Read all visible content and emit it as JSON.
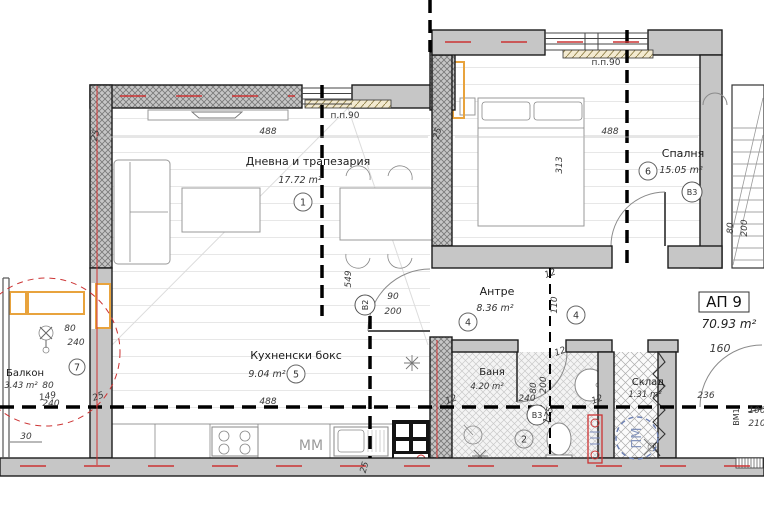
{
  "colors": {
    "wall_gray": "#c6c6c6",
    "accent_red": "#cc3333",
    "accent_orange": "#e8a33d",
    "accent_blue": "#6b7fb3",
    "sill_tan": "#f3ead0"
  },
  "apartment": {
    "label": "АП 9",
    "total_area": "70.93 m²"
  },
  "rooms": [
    {
      "number": "1",
      "name": "Дневна и трапезария",
      "area": "17.72 m²"
    },
    {
      "number": "2",
      "name": "Баня",
      "area": "4.20 m²"
    },
    {
      "number": "4",
      "name": "Антре",
      "area": "8.36 m²"
    },
    {
      "number": "5",
      "name": "Кухненски бокс",
      "area": "9.04 m²"
    },
    {
      "number": "6",
      "name": "Спалня",
      "area": "15.05 m²"
    },
    {
      "number": "7",
      "name": "Балкон",
      "area": "3.43 m²"
    },
    {
      "number": "",
      "name": "Склад",
      "area": "1.31 m²"
    }
  ],
  "doors": [
    {
      "id": "В2",
      "w": "90",
      "h": "200"
    },
    {
      "id": "В3",
      "w": "80",
      "h": "200"
    },
    {
      "id": "ВМ1",
      "w": "100",
      "h": "210"
    }
  ],
  "windows": [
    {
      "label": "п.п.90"
    },
    {
      "label": "п.п.90"
    }
  ],
  "appliances": {
    "dishwasher": "ММ",
    "pm": "ПМ"
  },
  "dims": {
    "living_w": "488",
    "wall_a": "25",
    "col": "25",
    "bedroom_w": "488",
    "bedroom_d": "313",
    "living_h": "549",
    "hall_a": "12",
    "hall_b": "110",
    "hall_c": "12",
    "bath_a": "240",
    "bath_d": "12",
    "bath_e": "12",
    "bath_f": "175",
    "kitchen_w": "488",
    "kitchen_a": "25",
    "balcony_a": "80",
    "balcony_b": "240",
    "balcony_c": "80",
    "balcony_d": "149",
    "balcony_e": "240",
    "balcony_f": "25",
    "balcony_g": "30",
    "corridor_a": "160",
    "corridor_b": "236"
  }
}
